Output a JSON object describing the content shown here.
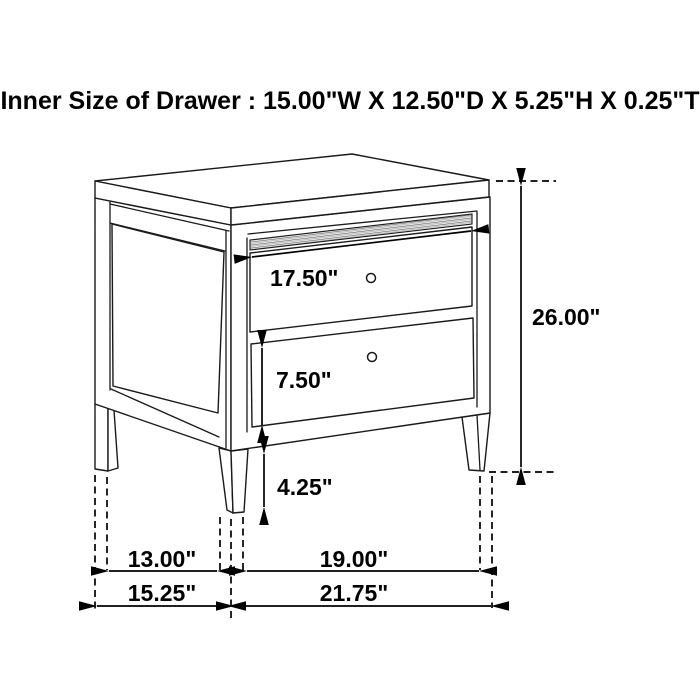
{
  "title": "Inner Size of Drawer : 15.00\"W X 12.50\"D X 5.25\"H X 0.25\"T",
  "diagram": {
    "type": "furniture-dimension-diagram",
    "subject": "two-drawer nightstand line drawing",
    "background_color": "#ffffff",
    "line_color": "#1a1a1a",
    "text_color": "#000000"
  },
  "dimensions": {
    "drawer_face_width": "17.50\"",
    "overall_height": "26.00\"",
    "bottom_drawer_height": "7.50\"",
    "leg_height": "4.25\"",
    "side_inner_span": "13.00\"",
    "front_inner_span": "19.00\"",
    "overall_depth": "15.25\"",
    "overall_width": "21.75\""
  }
}
